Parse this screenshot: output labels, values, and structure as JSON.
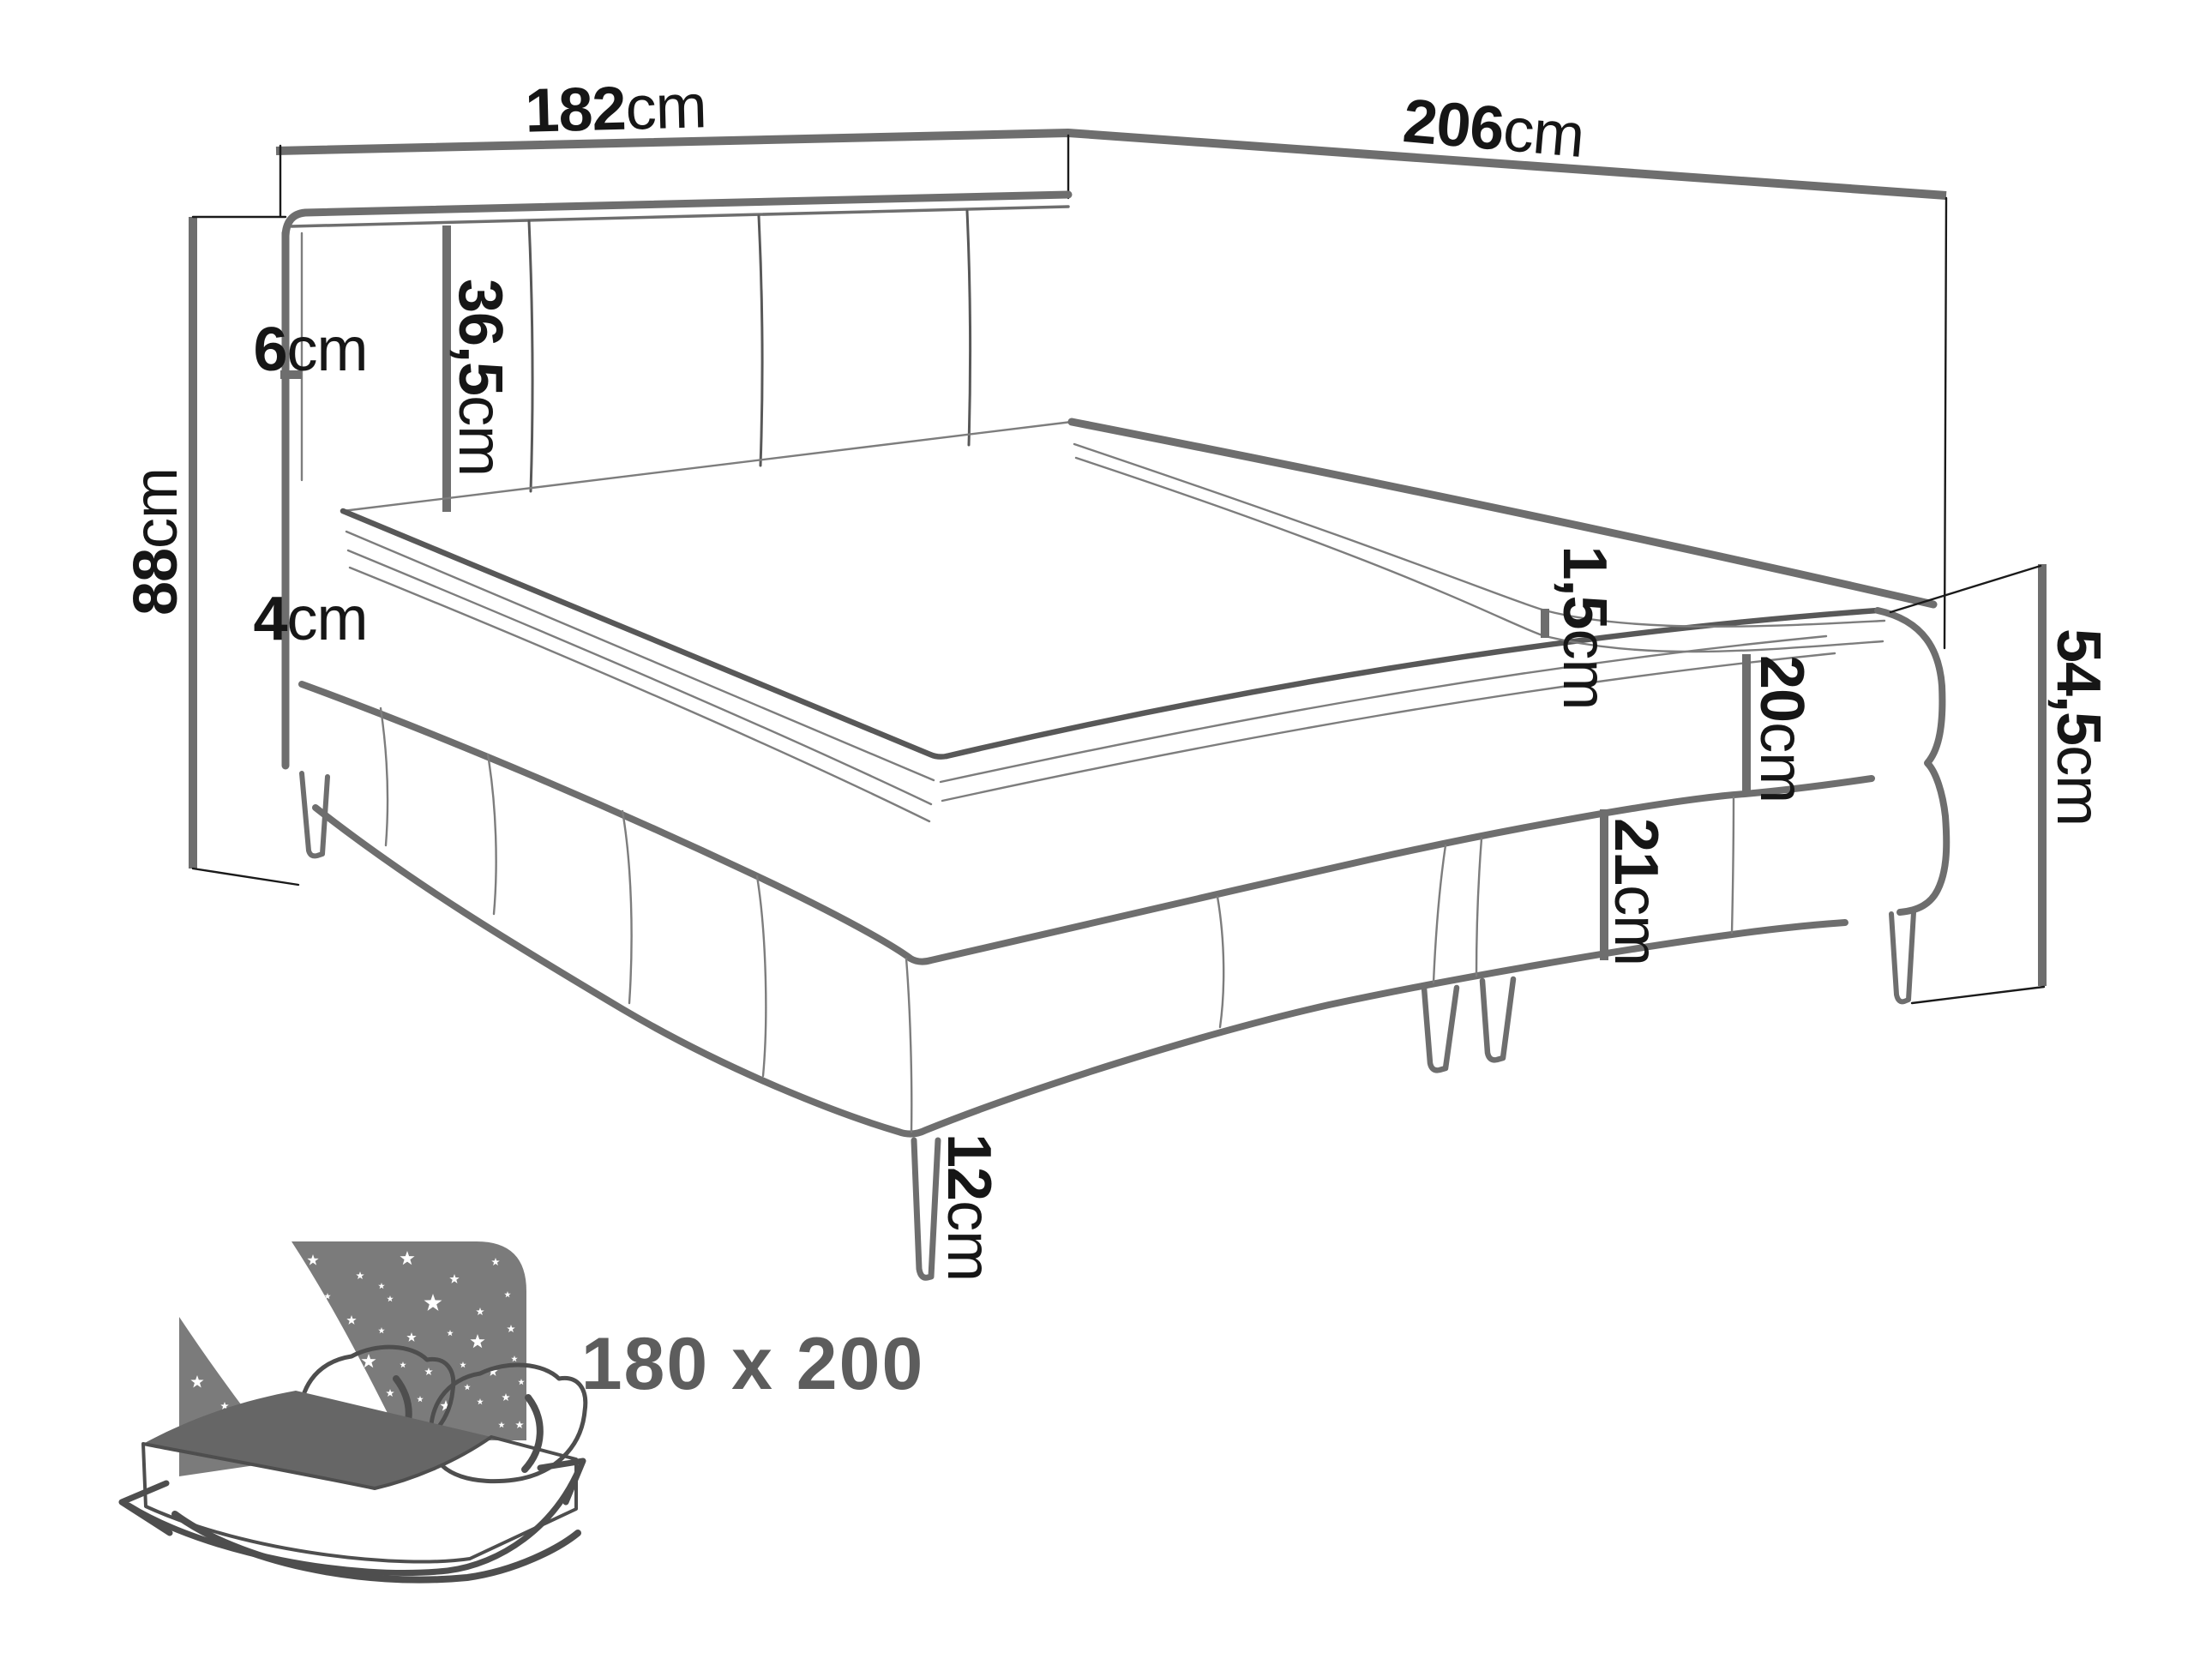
{
  "diagram": {
    "subject": "corner-boxspring-bed-dimensions",
    "dimensions": {
      "width_back": {
        "num": "182",
        "unit": "cm"
      },
      "length_side": {
        "num": "206",
        "unit": "cm"
      },
      "headboard_height": {
        "num": "88",
        "unit": "cm"
      },
      "headboard_edge": {
        "num": "6",
        "unit": "cm"
      },
      "panel_width": {
        "num": "36,5",
        "unit": "cm"
      },
      "topper_height": {
        "num": "4",
        "unit": "cm"
      },
      "seam_gap": {
        "num": "1,5",
        "unit": "cm"
      },
      "mattress_height": {
        "num": "20",
        "unit": "cm"
      },
      "base_height": {
        "num": "21",
        "unit": "cm"
      },
      "side_height": {
        "num": "54,5",
        "unit": "cm"
      },
      "leg_height": {
        "num": "12",
        "unit": "cm"
      }
    },
    "size_badge": "180 x 200",
    "icon": "bed-size-icon",
    "colors": {
      "line_gray": "#6e6e6e",
      "tick_black": "#1a1a1a",
      "label_black": "#161616",
      "badge_gray": "#5d5d5d",
      "icon_panel_gray": "#7b7b7b",
      "icon_mattress_gray": "#666666",
      "background": "#ffffff"
    }
  }
}
